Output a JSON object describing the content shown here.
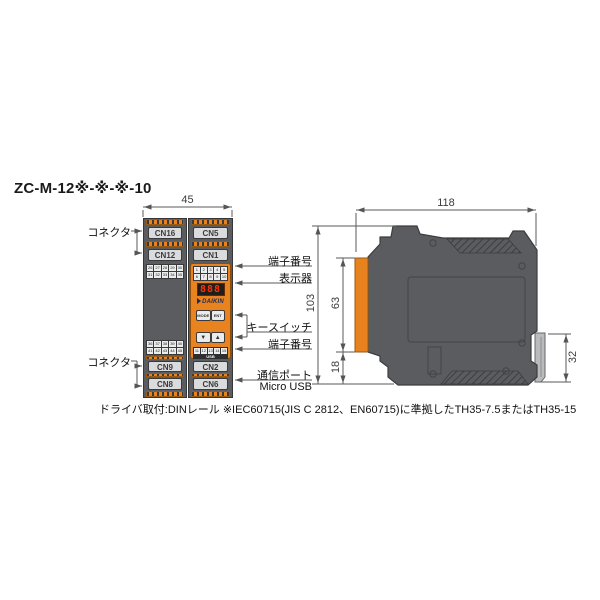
{
  "title": "ZC-M-12※-※-※-10",
  "footnote": "ドライバ取付:DINレール ※IEC60715(JIS C 2812、EN60715)に準拠したTH35-7.5またはTH35-15",
  "colors": {
    "accent_orange": "#e8821f",
    "body_gray": "#5b5c5f",
    "display_red": "#ff3400"
  },
  "front_view": {
    "dimension_width": "45",
    "connector_label": "コネクタ",
    "callouts": {
      "terminal_no_top": "端子番号",
      "display": "表示器",
      "key_switch": "キースイッチ",
      "terminal_no_bottom": "端子番号",
      "comm_port": "通信ポート",
      "micro_usb": "Micro USB"
    },
    "modules": {
      "left": {
        "connectors_top": [
          "CN16",
          "CN12"
        ],
        "connectors_bottom": [
          "CN9",
          "CN8"
        ],
        "terminal_rows_top": [
          "26 27 28 29 30",
          "31 32 33 34 35"
        ],
        "terminal_rows_bottom": [
          "36 37 38 39 40",
          "41 42 43 44 45"
        ]
      },
      "right": {
        "connectors_top": [
          "CN5",
          "CN1"
        ],
        "connectors_bottom": [
          "CN2",
          "CN6"
        ],
        "terminal_rows_top": [
          "1 2 3 4 5",
          "6 7 8 9 10"
        ],
        "terminal_row_bottom": "11 12 13 14 15",
        "display_value": "888",
        "brand": "DAIKIN",
        "usb_label": "USB",
        "buttons": {
          "mode": "MODE",
          "ent": "ENT",
          "down": "▼",
          "up": "▲"
        }
      }
    }
  },
  "side_view": {
    "dimension_width": "118",
    "dimension_height": "103",
    "dimension_front_face": "63",
    "dimension_bottom": "18",
    "dimension_rail": "32"
  }
}
